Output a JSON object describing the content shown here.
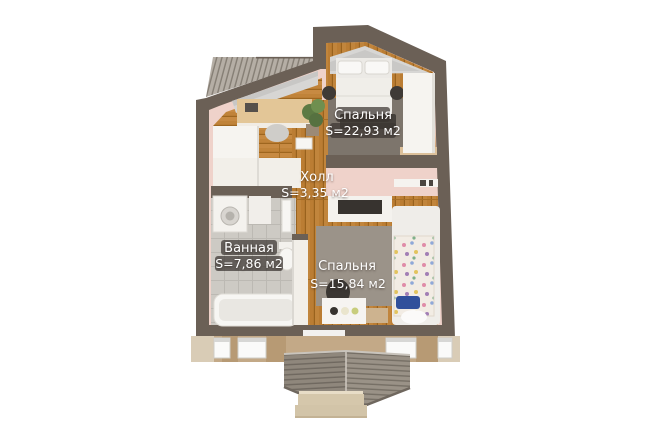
{
  "floor_plan": {
    "rooms": [
      {
        "id": "bedroom-top",
        "label": "Спальня",
        "area": "S=22,93 м2"
      },
      {
        "id": "hall",
        "label": "Холл",
        "area": "S=3,35 м2"
      },
      {
        "id": "bathroom",
        "label": "Ванная",
        "area": "S=7,86 м2"
      },
      {
        "id": "bedroom-bottom",
        "label": "Спальня",
        "area": "S=15,84 м2"
      }
    ],
    "colors": {
      "background": "#ffffff",
      "wall": "#6b6056",
      "wall_face_pink": "#efd2ca",
      "wood_floor": "#c08339",
      "tile_floor": "#cdcac4",
      "rug_dark": "#7d756c",
      "rug_light": "#9b9389",
      "facade": "#c3a987",
      "roof_slate": "#8f877c",
      "porch_stone": "#d5c7ab",
      "label_chip": "rgba(60,54,50,0.72)",
      "label_text": "#ffffff"
    }
  }
}
